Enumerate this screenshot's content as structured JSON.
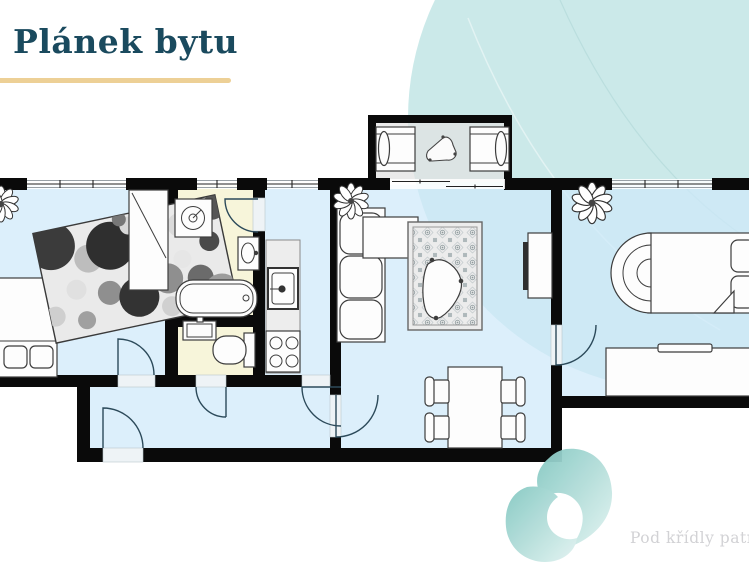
{
  "page": {
    "width": 749,
    "height": 562,
    "background_color": "#ffffff"
  },
  "header": {
    "title": "Plánek bytu",
    "title_color": "#1a4a5e",
    "underline_color": "#edd096"
  },
  "footer": {
    "caption": "Pod křídly patrona n",
    "text_color": "#d2d2d5"
  },
  "decor": {
    "background_circle_color": "#cbe9e9",
    "swirl_color_start": "#84c8c2",
    "swirl_color_end": "#e2f3f1"
  },
  "floorplan": {
    "wall_color": "#0a0a0a",
    "room_fill_color": "#cfe9fa",
    "wet_room_fill_color": "#f7f4d8",
    "balcony_fill_color": "#e2e2e2",
    "counter_fill_color": "#ededed",
    "rooms": [
      {
        "name": "bedroom"
      },
      {
        "name": "bathroom"
      },
      {
        "name": "wc"
      },
      {
        "name": "kitchen"
      },
      {
        "name": "living-room"
      },
      {
        "name": "hallway"
      },
      {
        "name": "bedroom-2"
      },
      {
        "name": "balcony"
      }
    ],
    "furniture_icons": [
      "bed-icon",
      "polka-dot-rug-icon",
      "wardrobe-icon",
      "plant-icon",
      "washing-machine-icon",
      "bathroom-sink-icon",
      "bathtub-icon",
      "wc-sink-icon",
      "toilet-icon",
      "kitchen-counter-icon",
      "kitchen-sink-icon",
      "stove-icon",
      "sofa-icon",
      "ornamental-rug-icon",
      "coffee-table-icon",
      "tv-stand-icon",
      "dining-table-icon",
      "chair-icon",
      "double-bed-icon",
      "desk-icon",
      "sun-lounger-icon",
      "balcony-table-icon",
      "door-swing-icon",
      "window-icon"
    ]
  }
}
